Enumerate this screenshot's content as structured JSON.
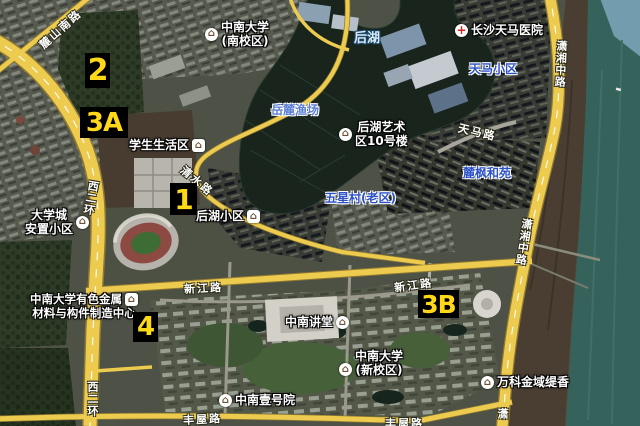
{
  "markers": [
    {
      "label": "2"
    },
    {
      "label": "3A"
    },
    {
      "label": "1"
    },
    {
      "label": "4"
    },
    {
      "label": "3B"
    }
  ],
  "pois": [
    {
      "name": "中南大学(南校区)",
      "line1": "中南大学",
      "line2": "(南校区)",
      "icon": "university"
    },
    {
      "name": "长沙天马医院",
      "line1": "长沙天马医院",
      "icon": "hospital"
    },
    {
      "name": "学生生活区",
      "line1": "学生生活区",
      "icon": "house"
    },
    {
      "name": "后湖艺术区10号楼",
      "line1": "后湖艺术",
      "line2": "区10号楼",
      "icon": "building"
    },
    {
      "name": "大学城安置小区",
      "line1": "大学城",
      "line2": "安置小区",
      "icon": "house"
    },
    {
      "name": "后湖小区",
      "line1": "后湖小区",
      "icon": "house"
    },
    {
      "name": "中南大学有色金属材料与构件制造中心",
      "line1": "中南大学有色金属",
      "line2": "材料与构件制造中心",
      "icon": "factory"
    },
    {
      "name": "中南讲堂",
      "line1": "中南讲堂",
      "icon": "building"
    },
    {
      "name": "中南大学(新校区)",
      "line1": "中南大学",
      "line2": "(新校区)",
      "icon": "university"
    },
    {
      "name": "中南壹号院",
      "line1": "中南壹号院",
      "icon": "building"
    },
    {
      "name": "万科金域缇香",
      "line1": "万科金域缇香",
      "icon": "house"
    }
  ],
  "roads": [
    {
      "name": "麓山南路"
    },
    {
      "name": "西二环"
    },
    {
      "name": "西二环"
    },
    {
      "name": "清水路"
    },
    {
      "name": "新江路"
    },
    {
      "name": "新江路"
    },
    {
      "name": "潇湘中路"
    },
    {
      "name": "潇湘中路"
    },
    {
      "name": "天马路"
    },
    {
      "name": "丰屋路"
    },
    {
      "name": "丰屋路"
    },
    {
      "name": "潇"
    }
  ],
  "areas": [
    {
      "name": "后湖",
      "type": "water"
    },
    {
      "name": "岳麓渔场",
      "type": "water"
    },
    {
      "name": "天马小区",
      "type": "residential"
    },
    {
      "name": "麓枫和苑",
      "type": "residential"
    },
    {
      "name": "五星村(老区)",
      "type": "residential"
    }
  ],
  "colors": {
    "road_fill": "#eccb4f",
    "marker_bg": "#000000",
    "marker_text": "#ffd918",
    "lake": "#18241c",
    "river": "#35635c",
    "poi_text": "#ffffff",
    "area_text": "#2b50c8"
  }
}
